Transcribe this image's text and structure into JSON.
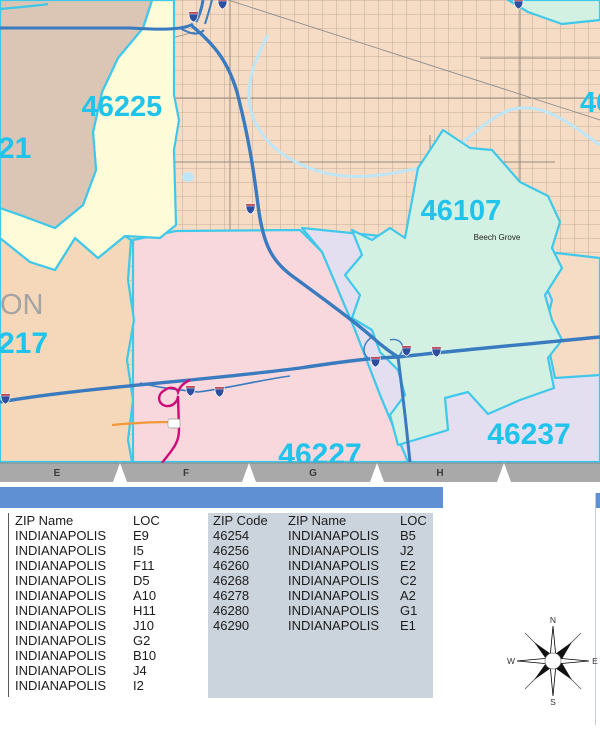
{
  "map": {
    "zip_labels": [
      {
        "text": "46225"
      },
      {
        "text": "21"
      },
      {
        "text": "217"
      },
      {
        "text": "46107"
      },
      {
        "text": "46227"
      },
      {
        "text": "46237"
      },
      {
        "text": "46"
      }
    ],
    "county_label": "ON",
    "place_label": "Beech Grove",
    "ruler_letters": [
      "E",
      "F",
      "G",
      "H"
    ],
    "colors": {
      "zip_label": "#1fc3ec",
      "boundary": "#3fc8e9",
      "water": "#bfe6f6",
      "highway": "#3a7abf",
      "route_magenta": "#cf0a78",
      "route_orange": "#f0983a",
      "region_peach": "#f6dcc4",
      "region_yellow": "#fdfbd8",
      "region_pink": "#f8d8dc",
      "region_lavender": "#e4def1",
      "region_mint": "#d2f1e2",
      "region_tan": "#dbc6b6",
      "region_apricot": "#f5d8ba",
      "table_header_bar": "#6090d4",
      "table_zip_col": "#cbd4dd"
    }
  },
  "panel": {
    "left_table": {
      "headers": [
        "ZIP Name",
        "LOC"
      ],
      "rows": [
        [
          "INDIANAPOLIS",
          "E9"
        ],
        [
          "INDIANAPOLIS",
          "I5"
        ],
        [
          "INDIANAPOLIS",
          "F11"
        ],
        [
          "INDIANAPOLIS",
          "D5"
        ],
        [
          "INDIANAPOLIS",
          "A10"
        ],
        [
          "INDIANAPOLIS",
          "H11"
        ],
        [
          "INDIANAPOLIS",
          "J10"
        ],
        [
          "INDIANAPOLIS",
          "G2"
        ],
        [
          "INDIANAPOLIS",
          "B10"
        ],
        [
          "INDIANAPOLIS",
          "J4"
        ],
        [
          "INDIANAPOLIS",
          "I2"
        ]
      ]
    },
    "right_table": {
      "headers": [
        "ZIP Code",
        "ZIP Name",
        "LOC"
      ],
      "rows": [
        [
          "46254",
          "INDIANAPOLIS",
          "B5"
        ],
        [
          "46256",
          "INDIANAPOLIS",
          "J2"
        ],
        [
          "46260",
          "INDIANAPOLIS",
          "E2"
        ],
        [
          "46268",
          "INDIANAPOLIS",
          "C2"
        ],
        [
          "46278",
          "INDIANAPOLIS",
          "A2"
        ],
        [
          "46280",
          "INDIANAPOLIS",
          "G1"
        ],
        [
          "46290",
          "INDIANAPOLIS",
          "E1"
        ]
      ]
    }
  },
  "compass": {
    "n": "N",
    "e": "E",
    "s": "S",
    "w": "W"
  }
}
